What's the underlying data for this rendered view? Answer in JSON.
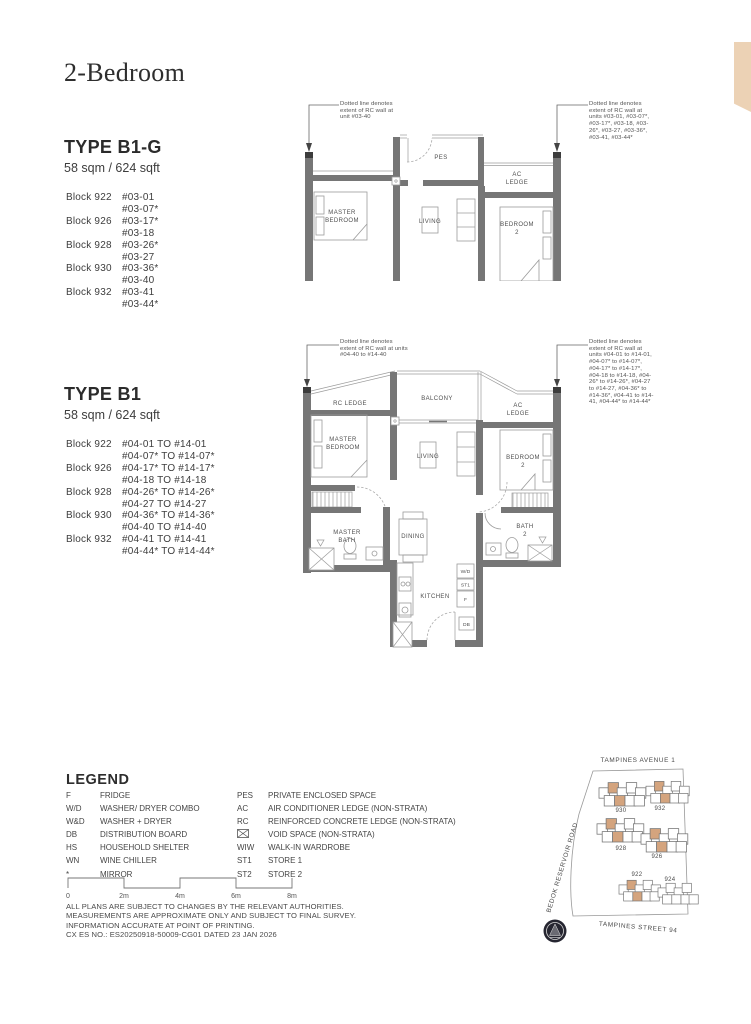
{
  "page": {
    "title": "2-Bedroom"
  },
  "colors": {
    "corner_tab": "#ecd2b5",
    "wall_gray": "#767676",
    "site_highlight": "#cf9f77",
    "compass": "#262631"
  },
  "type_b1g": {
    "name": "TYPE B1-G",
    "area": "58 sqm / 624 sqft",
    "rows": [
      [
        "Block 922",
        "#03-01"
      ],
      [
        "",
        "#03-07*"
      ],
      [
        "Block 926",
        "#03-17*"
      ],
      [
        "",
        "#03-18"
      ],
      [
        "Block 928",
        "#03-26*"
      ],
      [
        "",
        "#03-27"
      ],
      [
        "Block 930",
        "#03-36*"
      ],
      [
        "",
        "#03-40"
      ],
      [
        "Block 932",
        "#03-41"
      ],
      [
        "",
        "#03-44*"
      ]
    ]
  },
  "type_b1": {
    "name": "TYPE B1",
    "area": "58 sqm / 624 sqft",
    "rows": [
      [
        "Block 922",
        "#04-01 TO #14-01"
      ],
      [
        "",
        "#04-07* TO #14-07*"
      ],
      [
        "Block 926",
        "#04-17* TO #14-17*"
      ],
      [
        "",
        "#04-18 TO #14-18"
      ],
      [
        "Block 928",
        "#04-26* TO #14-26*"
      ],
      [
        "",
        "#04-27 TO #14-27"
      ],
      [
        "Block 930",
        "#04-36* TO #14-36*"
      ],
      [
        "",
        "#04-40 TO #14-40"
      ],
      [
        "Block 932",
        "#04-41 TO #14-41"
      ],
      [
        "",
        "#04-44* TO #14-44*"
      ]
    ]
  },
  "plan_b1g": {
    "annotation_left": "Dotted line denotes extent of RC wall at unit #03-40",
    "annotation_right": "Dotted line denotes extent of RC wall at units #03-01, #03-07*, #03-17*, #03-18, #03-26*, #03-27, #03-36*, #03-41, #03-44*",
    "rooms": {
      "pes": [
        "PES"
      ],
      "ac_ledge": [
        "AC",
        "LEDGE"
      ],
      "master_bedroom": [
        "MASTER",
        "BEDROOM"
      ],
      "living": [
        "LIVING"
      ],
      "bedroom2": [
        "BEDROOM",
        "2"
      ]
    }
  },
  "plan_b1": {
    "annotation_left": "Dotted line denotes extent of RC wall at units #04-40 to #14-40",
    "annotation_right": "Dotted line denotes extent of RC wall at units #04-01 to #14-01, #04-07* to #14-07*, #04-17* to #14-17*, #04-18 to #14-18, #04-26* to #14-26*, #04-27 to #14-27, #04-36* to #14-36*, #04-41 to #14-41, #04-44* to #14-44*",
    "rooms": {
      "rc_ledge": [
        "RC LEDGE"
      ],
      "balcony": [
        "BALCONY"
      ],
      "ac_ledge": [
        "AC",
        "LEDGE"
      ],
      "master_bedroom": [
        "MASTER",
        "BEDROOM"
      ],
      "living": [
        "LIVING"
      ],
      "bedroom2": [
        "BEDROOM",
        "2"
      ],
      "master_bath": [
        "MASTER",
        "BATH"
      ],
      "dining": [
        "DINING"
      ],
      "bath2": [
        "BATH",
        "2"
      ],
      "kitchen": [
        "KITCHEN"
      ],
      "wd": "W/D",
      "st1": "ST1",
      "f": "F",
      "db": "DB"
    }
  },
  "legend": {
    "heading": "LEGEND",
    "left_rows": [
      [
        "F",
        "FRIDGE"
      ],
      [
        "W/D",
        "WASHER/ DRYER COMBO"
      ],
      [
        "W&D",
        "WASHER + DRYER"
      ],
      [
        "DB",
        "DISTRIBUTION BOARD"
      ],
      [
        "HS",
        "HOUSEHOLD SHELTER"
      ],
      [
        "WN",
        "WINE CHILLER"
      ],
      [
        "*",
        "MIRROR"
      ]
    ],
    "right_rows": [
      [
        "PES",
        "PRIVATE ENCLOSED SPACE"
      ],
      [
        "AC",
        "AIR CONDITIONER LEDGE (NON-STRATA)"
      ],
      [
        "RC",
        "REINFORCED CONCRETE LEDGE (NON-STRATA)"
      ],
      [
        "",
        "VOID SPACE (NON-STRATA)"
      ],
      [
        "WIW",
        "WALK-IN WARDROBE"
      ],
      [
        "ST1",
        "STORE 1"
      ],
      [
        "ST2",
        "STORE 2"
      ]
    ]
  },
  "scalebar": {
    "labels": [
      "0",
      "2m",
      "4m",
      "6m",
      "8m"
    ]
  },
  "disclaimer": [
    "ALL PLANS ARE SUBJECT TO CHANGES BY THE RELEVANT AUTHORITIES.",
    "MEASUREMENTS ARE APPROXIMATE ONLY AND SUBJECT TO FINAL SURVEY.",
    "INFORMATION ACCURATE AT POINT OF PRINTING.",
    "CX ES NO.: ES20250918-50009-CG01 DATED 23 JAN 2026"
  ],
  "sitemap": {
    "road_top": "TAMPINES AVENUE 1",
    "road_left": "BEDOK RESERVOIR ROAD",
    "road_bottom": "TAMPINES STREET 94",
    "block_labels": [
      "930",
      "932",
      "928",
      "926",
      "922",
      "924"
    ]
  }
}
